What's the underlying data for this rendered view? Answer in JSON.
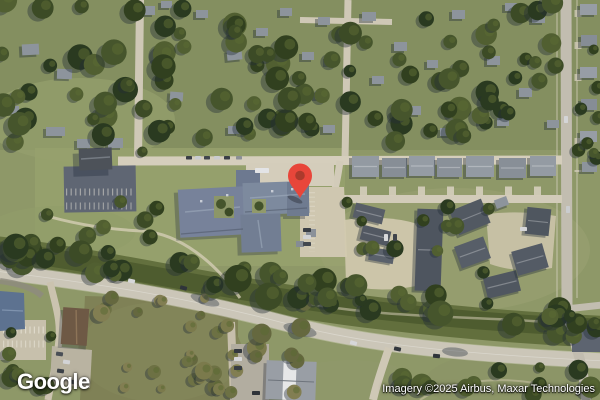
{
  "map": {
    "view_type": "satellite",
    "logo_text": "Google",
    "attribution_text": "Imagery ©2025 Airbus, Maxar Technologies",
    "marker": {
      "icon": "map-pin-icon",
      "color": "#E8463A",
      "dot_color": "#AC3A2C",
      "transform": "translate(300,198)"
    },
    "palette": {
      "vegetation_base": "#8E9868",
      "tree_dark": "#3C4B26",
      "road_tan": "#D0CABA",
      "roof_gray": "#8D949C",
      "roof_dark": "#51575F",
      "school_roof": "#77829A",
      "asphalt": "#5F6673"
    }
  }
}
